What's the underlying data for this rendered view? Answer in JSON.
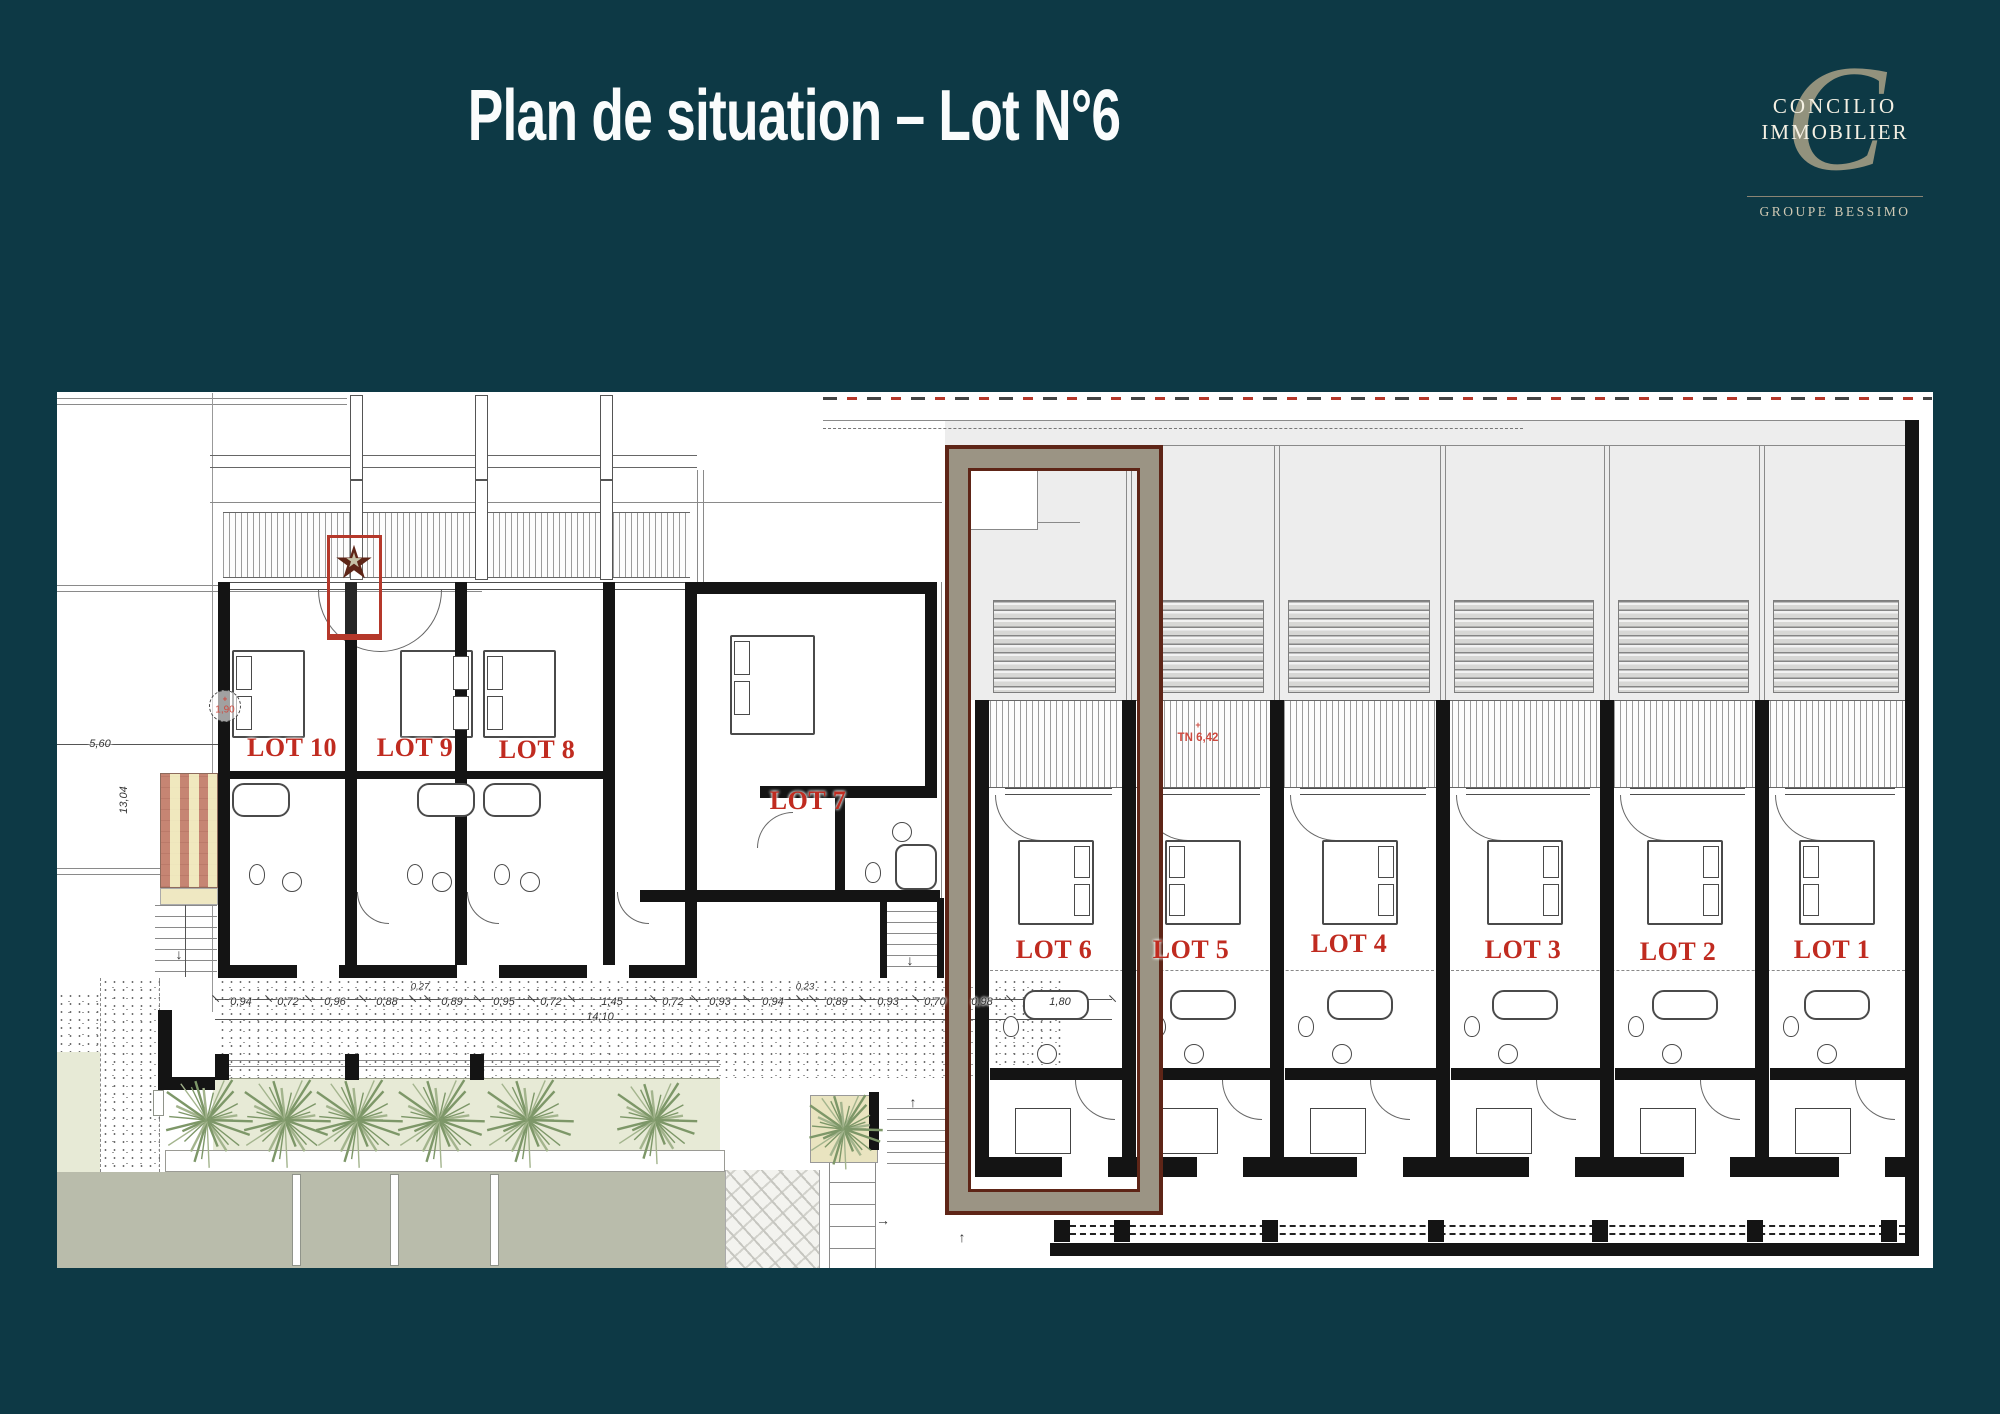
{
  "slide": {
    "background": "#0d3945",
    "title": "Plan de situation – Lot N°6"
  },
  "logo": {
    "monogram": "C",
    "name_line1": "CONCILIO",
    "name_line2": "IMMOBILIER",
    "group": "GROUPE BESSIMO"
  },
  "plan": {
    "highlight_lot": "LOT 6",
    "colors": {
      "lot_label": "#c02b20",
      "annotation_red": "#cf4a3f",
      "frame_taupe": "#9b9484",
      "frame_maroon": "#5e2517",
      "roof_gray": "#ededed",
      "garden_green": "#e7ead6",
      "road_gray": "#b9bcab",
      "plant_green": "#7d9768",
      "highlight_box_red": "#b5382a",
      "star_beige": "#c5c1a6"
    },
    "lot_labels": [
      {
        "label": "LOT 10",
        "x": 235,
        "y": 356
      },
      {
        "label": "LOT 9",
        "x": 358,
        "y": 356
      },
      {
        "label": "LOT 8",
        "x": 480,
        "y": 358
      },
      {
        "label": "LOT 7",
        "x": 751,
        "y": 409
      },
      {
        "label": "LOT 6",
        "x": 997,
        "y": 558
      },
      {
        "label": "LOT 5",
        "x": 1134,
        "y": 558
      },
      {
        "label": "LOT 4",
        "x": 1292,
        "y": 552
      },
      {
        "label": "LOT 3",
        "x": 1466,
        "y": 558
      },
      {
        "label": "LOT 2",
        "x": 1621,
        "y": 560
      },
      {
        "label": "LOT 1",
        "x": 1775,
        "y": 558
      }
    ],
    "dimension_chain": [
      {
        "text": "0,94",
        "x": 184,
        "y": 610
      },
      {
        "text": "0,72",
        "x": 231,
        "y": 610
      },
      {
        "text": "0,96",
        "x": 278,
        "y": 610
      },
      {
        "text": "0,88",
        "x": 330,
        "y": 610
      },
      {
        "text": "0,27",
        "x": 363,
        "y": 595,
        "small": true
      },
      {
        "text": "0,89",
        "x": 395,
        "y": 610
      },
      {
        "text": "0,95",
        "x": 447,
        "y": 610
      },
      {
        "text": "0,72",
        "x": 494,
        "y": 610
      },
      {
        "text": "1,45",
        "x": 555,
        "y": 610
      },
      {
        "text": "0,72",
        "x": 616,
        "y": 610
      },
      {
        "text": "0,93",
        "x": 663,
        "y": 610
      },
      {
        "text": "0,94",
        "x": 716,
        "y": 610
      },
      {
        "text": "0,23",
        "x": 748,
        "y": 595,
        "small": true
      },
      {
        "text": "0,89",
        "x": 780,
        "y": 610
      },
      {
        "text": "0,93",
        "x": 831,
        "y": 610
      },
      {
        "text": "0,70",
        "x": 878,
        "y": 610
      },
      {
        "text": "0,98",
        "x": 925,
        "y": 610
      },
      {
        "text": "1,80",
        "x": 1003,
        "y": 610
      }
    ],
    "dimensions_other": [
      {
        "text": "14,10",
        "x": 543,
        "y": 625
      },
      {
        "text": "5,60",
        "x": 43,
        "y": 352
      },
      {
        "text": "13,04",
        "x": 67,
        "y": 408,
        "rot": true
      }
    ],
    "annotations": [
      {
        "text": "TN 6,42",
        "x": 1141,
        "y": 346
      },
      {
        "text": "1,90",
        "x": 168,
        "y": 316
      }
    ]
  }
}
